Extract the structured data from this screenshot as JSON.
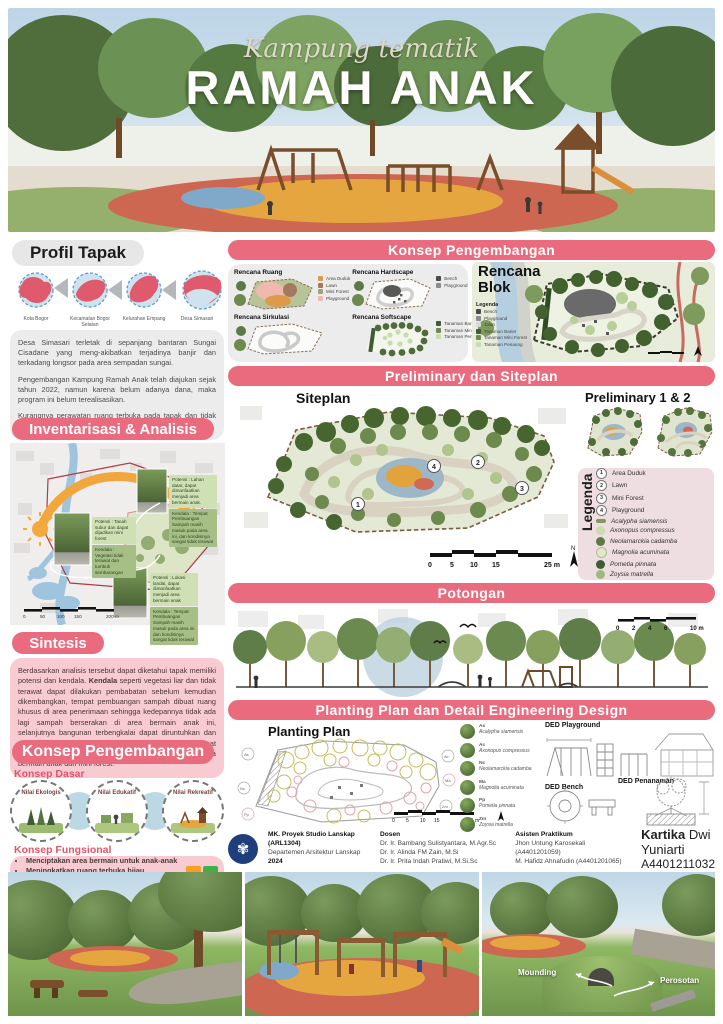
{
  "colors": {
    "accent_pink": "#EA6B7E",
    "light_pink": "#F7CBD1",
    "panel_gray": "#ECECEC",
    "tanaman_barier_green": "#3F5C34",
    "tanaman_mini_forest_green": "#6B8A4F",
    "tanaman_penaung_green": "#CBDCB2"
  },
  "hero": {
    "title_script": "Kampung tematik",
    "title_main": "RAMAH ANAK"
  },
  "profil_tapak": {
    "heading": "Profil Tapak",
    "map_labels": [
      "Kota Bogor",
      "Kecamatan Bogor Selatan",
      "Kelurahan Empang",
      "Desa Simasari"
    ],
    "paragraphs": [
      "Desa Simasari terletak di sepanjang bantaran Sungai Cisadane yang meng-akibatkan terjadinya banjir dan terkadang longsor pada area sempadan sungai.",
      "Pengembangan Kampung Ramah Anak telah diajukan sejak tahun 2022, namun karena belum adanya dana, maka program ini belum terealisasikan.",
      "Kurangnya perawatan ruang terbuka pada tapak dan tidak terdapat area bermain untuk anak-anak sekitar."
    ]
  },
  "inventarisasi": {
    "heading": "Inventarisasi & Analisis",
    "callouts": [
      {
        "potensi": "Potensi : Lahan datar, dapat dimanfaatkan menjadi area bermain anak.",
        "kendala": "Kendala : Tempat Pembuangan Sampah masih masuk pada area ini, dan kondisinya sangat tidak terawat"
      },
      {
        "potensi": "Potensi : Tanah subur dan dapat dijadikan mini forest",
        "kendala": "Kendala : Vegetasi tidak terawat dan tumbuh sembarangan"
      },
      {
        "potensi": "Potensi : Lokasi landai, dapat dimanfaatkan menjadi area bermain anak",
        "kendala": "Kendala : Tempat Pembuangan Sampah masih masuk pada area ini dan kondisinya sangat tidak terawat"
      }
    ],
    "scale_ticks": [
      "0",
      "50",
      "100",
      "150",
      "200 m"
    ]
  },
  "sintesis": {
    "heading": "Sintesis",
    "pre": "Berdasarkan analisis tersebut dapat diketahui tapak memiliki potensi dan kendala. ",
    "bold1": "Kendala",
    "mid": " seperti vegetasi liar dan tidak terawat dapat dilakukan pembabatan sebelum kemudian dikembangkan, tempat pembuangan sampah dibuat ruang khusus di area penerimaan sehingga kedepannya tidak ada lagi sampah berserakan di area bermain anak ini, selanjutnya bangunan terbengkalai dapat diruntuhkan dan diratakan dengan tanah sehingga tapak dapat dikembangkan. Tapak ini ",
    "bold2": "berpotensi",
    "post": " untuk dibangun area bermain anak dan mini forest."
  },
  "konsep_kiri": {
    "heading": "Konsep Pengembangan",
    "dasar_label": "Konsep Dasar",
    "nilai": [
      "Nilai Ekologis",
      "Nilai Edukatif",
      "Nilai Rekreatif"
    ],
    "fungsional_label": "Konsep Fungsional",
    "bullets": [
      "Menciptakan area bermain untuk anak-anak",
      "Meningkatkan ruang terbuka hijau",
      "Mengoptimalkan fungsi lahan terbengkalai sebagai area rekreasi untuk meningkatkan perekonomian"
    ]
  },
  "konsep_kanan": {
    "heading": "Konsep Pengembangan",
    "plans": [
      {
        "title": "Rencana Ruang",
        "legend": [
          "Area Duduk",
          "Lawn",
          "Mini Forest",
          "Playground"
        ]
      },
      {
        "title": "Rencana Hardscape",
        "legend": [
          "Bench",
          "Playground"
        ]
      },
      {
        "title": "Rencana Sirkulasi",
        "legend": []
      },
      {
        "title": "Rencana Softscape",
        "legend": [
          "Tanaman Barier",
          "Tanaman Mini Forest",
          "Tanaman Penaung"
        ]
      }
    ],
    "blok": {
      "title": "Rencana Blok",
      "legenda_label": "Legenda",
      "items": [
        "Bench",
        "Playground",
        "Jalan",
        "Tanaman Barier",
        "Tanaman Mini Forest",
        "Tanaman Penaung"
      ]
    }
  },
  "preliminary": {
    "heading": "Preliminary dan Siteplan",
    "siteplan_label": "Siteplan",
    "preliminary_label": "Preliminary 1 & 2",
    "legenda_label": "Legenda",
    "zone_numbers": [
      "1",
      "2",
      "3",
      "4"
    ],
    "zones": [
      "Area Duduk",
      "Lawn",
      "Mini Forest",
      "Playground"
    ],
    "plants": [
      "Acalypha siamensis",
      "Axonopus compressus",
      "Neolamarckia cadamba",
      "Magnolia acuminata",
      "Pometia pinnata",
      "Zoysia matrella"
    ],
    "scale_ticks": [
      "0",
      "5",
      "10",
      "15",
      "25 m"
    ],
    "north_label": "N"
  },
  "potongan": {
    "heading": "Potongan",
    "scale_ticks": [
      "0",
      "2",
      "4",
      "6",
      "10 m"
    ]
  },
  "planting": {
    "heading": "Planting Plan dan Detail Engineering Design",
    "plan_label": "Planting Plan",
    "plant_list": [
      {
        "code": "As",
        "name": "Acalypha siamensis"
      },
      {
        "code": "Ac",
        "name": "Axonopus compressus"
      },
      {
        "code": "Nc",
        "name": "Neolamarckia cadamba"
      },
      {
        "code": "Ma",
        "name": "Magnolia acuminata"
      },
      {
        "code": "Pp",
        "name": "Pometia pinnata"
      },
      {
        "code": "Zm",
        "name": "Zoysia matrella"
      }
    ],
    "ded_labels": [
      "DED Playground",
      "DED Bench",
      "DED Penanaman"
    ],
    "scale_ticks": [
      "0",
      "5",
      "10",
      "15",
      "25 m"
    ]
  },
  "footer": {
    "course_line1": "MK. Proyek Studio Lanskap",
    "course_line2": "(ARL1304)",
    "dept": "Departemen Arsitektur Lanskap",
    "year": "2024",
    "dosen_label": "Dosen",
    "dosen": [
      "Dr. Ir. Bambang Sulistyantara, M.Agr.Sc",
      "Dr. Ir. Alinda FM Zain, M.Si",
      "Dr. Ir. Prita Indah Pratiwi, M.Si.Sc"
    ],
    "asisten_label": "Asisten Praktikum",
    "asisten": [
      "Jhon Untung Karosekali (A4401201059)",
      "M. Hafidz Ahnafudin (A4401201065)"
    ],
    "student_first": "Kartika",
    "student_rest": "Dwi Yuniarti",
    "student_id": "A4401211032"
  },
  "renders": {
    "labels": [
      "Mounding",
      "Perosotan"
    ]
  }
}
